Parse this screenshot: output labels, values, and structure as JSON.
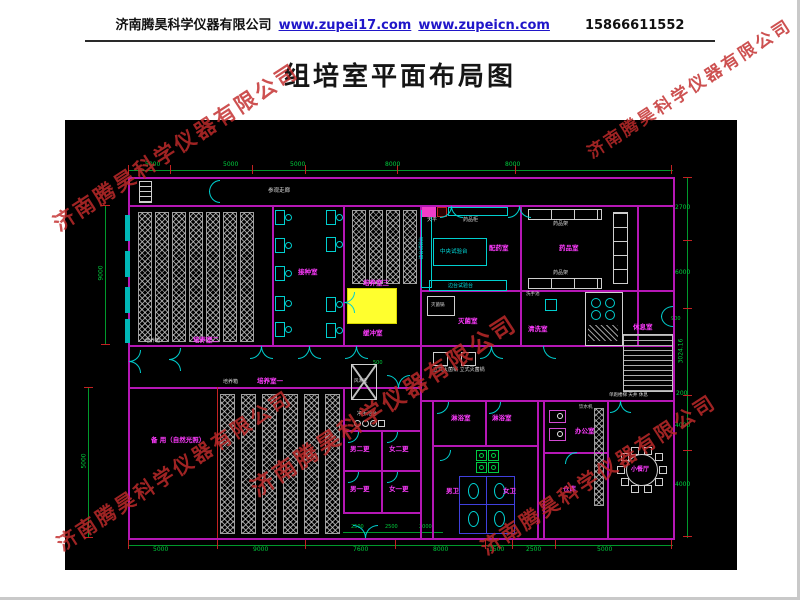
{
  "header": {
    "company": "济南腾昊科学仪器有限公司",
    "site1": "www.zupei17.com",
    "site2": "www.zupeicn.com",
    "phone": "15866611552"
  },
  "title": "组培室平面布局图",
  "watermark": {
    "text": "济南腾昊科学仪器有限公司"
  },
  "plan": {
    "corridor": "参观走廊",
    "rooms": {
      "culture2": "培养室二",
      "culture3": "培养室三",
      "culture1": "培养室一",
      "inoculation": "接种室",
      "buffer": "缓冲室",
      "prep": "配药室",
      "medicine": "药品室",
      "sterilize": "灭菌室",
      "wash": "清洗室",
      "rest": "休息室",
      "spare": "备 用（自然光照）",
      "airshower": "风淋室",
      "changeM2": "男二更",
      "changeF2": "女二更",
      "changeM1": "男一更",
      "changeF1": "女一更",
      "shower": "淋浴室",
      "wcM": "男卫",
      "wcF": "女卫",
      "office": "办公室",
      "store": "仓库",
      "dining": "小餐厅"
    },
    "equipment": {
      "incubator": "培养箱",
      "centralBench": "中央试验台",
      "sideBench": "边台试验台",
      "balance": "天平",
      "medCabinet": "药品柜",
      "medRack": "药品架",
      "autoclave": "灭菌锅",
      "autoclaves": "立式灭菌锅 立式灭菌锅",
      "handSink": "洗手池",
      "handWashStation": "净手池台",
      "waterDispenser": "饮水机",
      "stairNote": "单跑楼梯 天井 休息"
    },
    "dims": {
      "top": [
        "5000",
        "5000",
        "5000",
        "8000",
        "8000"
      ],
      "right": [
        "2700",
        "6000",
        "3024.16",
        "200",
        "4000",
        "4000"
      ],
      "bottom": [
        "5000",
        "9000",
        "7600",
        "8000",
        "1500",
        "2500",
        "5000"
      ],
      "bottom_sub": [
        "2500",
        "2500",
        "2000"
      ],
      "left": [
        "9000",
        "5000"
      ],
      "inner": {
        "airshower": "500",
        "right_door": "900"
      }
    }
  },
  "colors": {
    "wall": "#b517b5",
    "door": "#00cfcf",
    "dimension": "#00992b",
    "extension": "#c22222",
    "room_label": "#ff3bff",
    "equipment": "#d8d8d8",
    "highlight": "#ffff2e",
    "watermark": "#c32b2b",
    "link": "#2016c9"
  }
}
